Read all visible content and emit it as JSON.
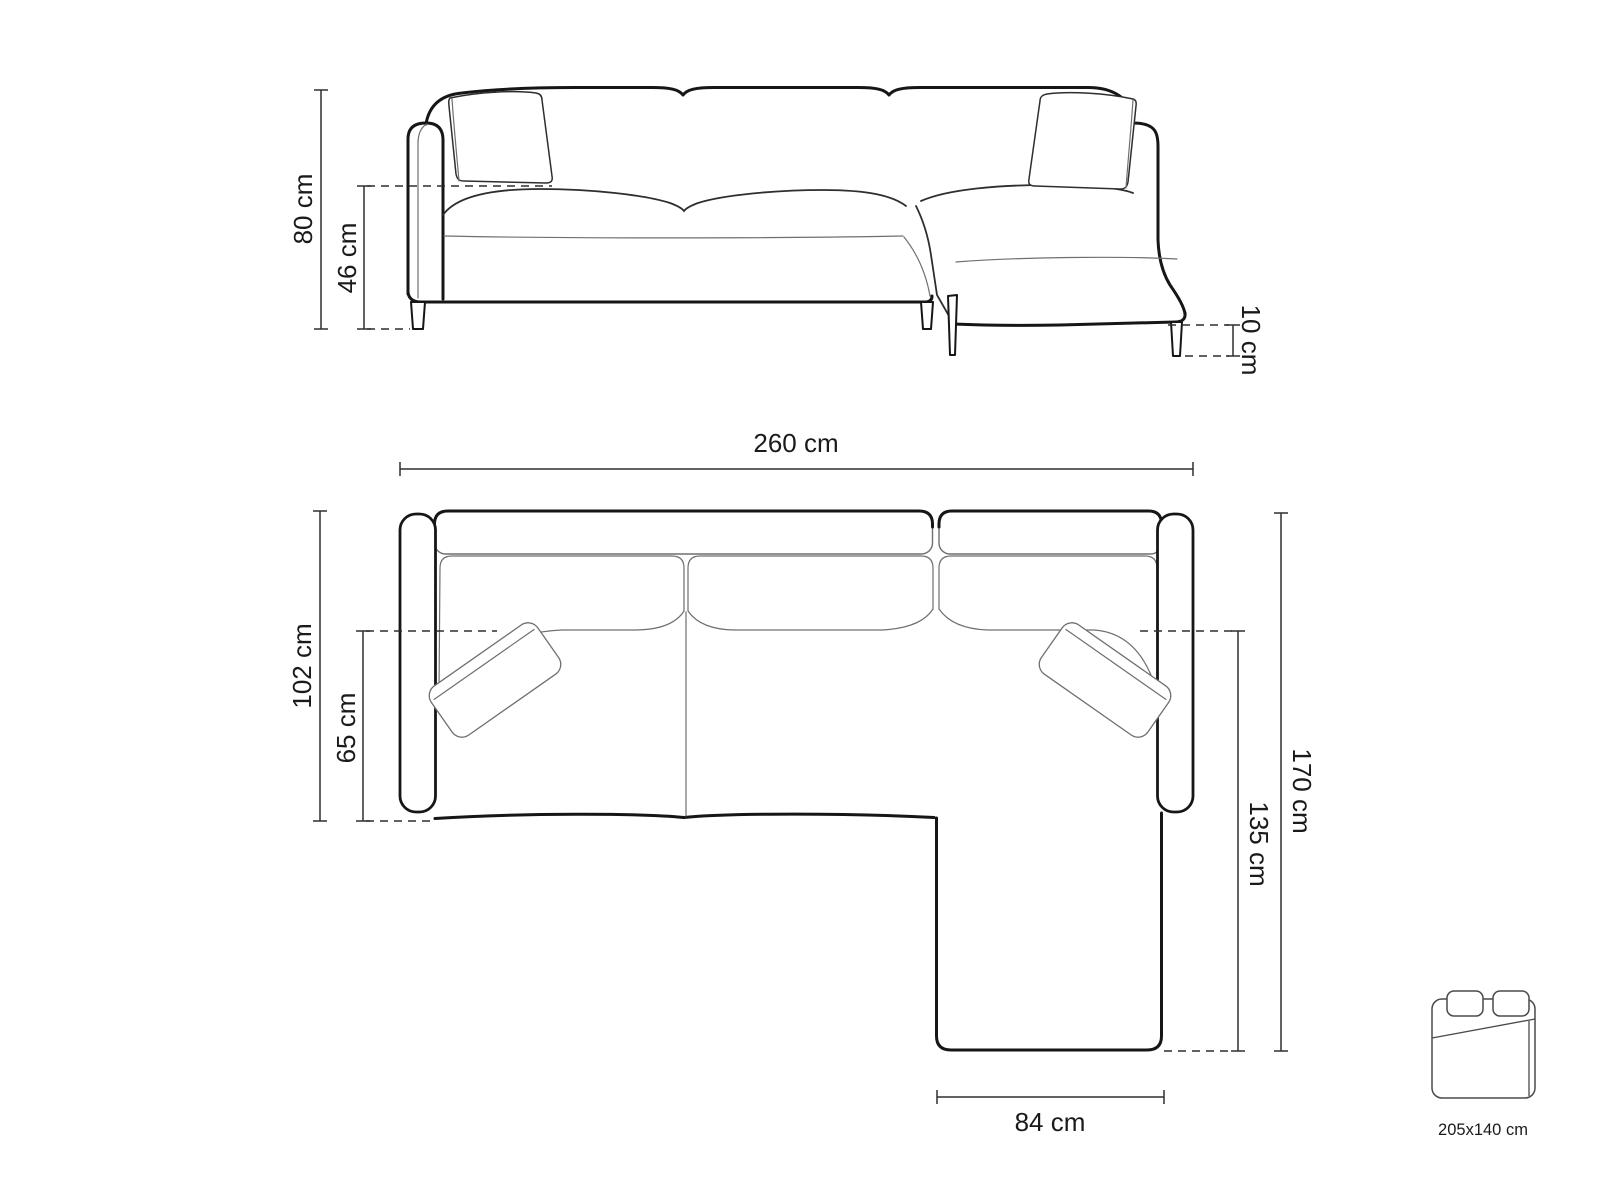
{
  "front_view": {
    "overall_height_label": "80 cm",
    "seat_height_label": "46 cm",
    "leg_height_label": "10 cm"
  },
  "top_view": {
    "overall_width_label": "260 cm",
    "overall_depth_label": "102 cm",
    "seat_depth_label": "65 cm",
    "total_length_label": "170 cm",
    "chaise_length_label": "135 cm",
    "chaise_width_label": "84 cm"
  },
  "sleeping_area": {
    "size_label": "205x140 cm"
  },
  "colors": {
    "outline": "#161616",
    "thin_line": "#6f6f6f",
    "medium_line": "#2e2e2e",
    "dimension_line": "#2f2f2f",
    "text": "#1a1a1a",
    "background": "#ffffff"
  }
}
